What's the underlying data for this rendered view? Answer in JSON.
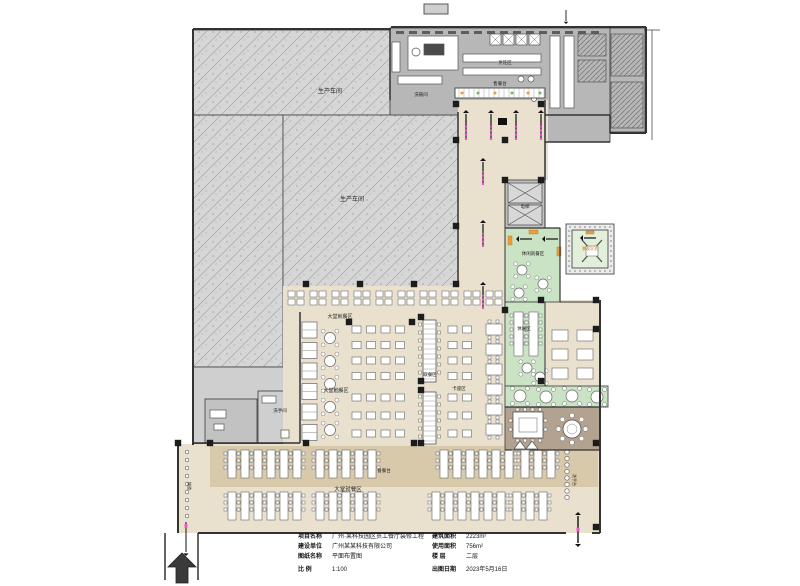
{
  "document": {
    "type": "architectural-floor-plan",
    "sheet_name": "平面布置图"
  },
  "colors": {
    "beige": "#e9e0cd",
    "tan": "#d8c9ab",
    "hatch_gray": "#d6d6d6",
    "room_gray": "#cfcfcf",
    "gray2": "#c2c2c2",
    "kitchen_gray": "#b7b7b7",
    "wall": "#333333",
    "green": "#c9e3c4",
    "pale_green": "#e2efdb",
    "stone": "#ededed",
    "taupe": "#b3a290",
    "magenta": "#ee55d2",
    "orange": "#eb9c3f",
    "white": "#ffffff",
    "ink": "#222222"
  },
  "titleblock": {
    "left": [
      {
        "label": "项目名称",
        "value": "广州·某科技园区员工餐厅装修工程"
      },
      {
        "label": "建设单位",
        "value": "广州某某科技有限公司"
      },
      {
        "label": "图纸名称",
        "value": "平面布置图"
      },
      {
        "label": "比    例",
        "value": "1:100"
      }
    ],
    "right": [
      {
        "label": "建筑面积",
        "value": "2223m²"
      },
      {
        "label": "使用面积",
        "value": "756m²"
      },
      {
        "label": "楼    层",
        "value": "二层"
      },
      {
        "label": "出图日期",
        "value": "2023年5月16日"
      }
    ]
  },
  "plan": {
    "regions": [
      {
        "name": "workshop-top",
        "x": 193,
        "y": 30,
        "w": 197,
        "h": 85,
        "f": "hatch"
      },
      {
        "name": "workshop-left",
        "x": 193,
        "y": 115,
        "w": 90,
        "h": 252,
        "f": "hatch"
      },
      {
        "name": "workshop-mid",
        "x": 283,
        "y": 115,
        "w": 175,
        "h": 173,
        "f": "hatch"
      },
      {
        "name": "utility-block",
        "x": 193,
        "y": 367,
        "w": 107,
        "h": 77,
        "f": "lightgray"
      },
      {
        "name": "utility-room-1",
        "x": 205,
        "y": 399,
        "w": 52,
        "h": 44,
        "f": "gray2"
      },
      {
        "name": "utility-room-2",
        "x": 258,
        "y": 391,
        "w": 42,
        "h": 52,
        "f": "lightgray"
      },
      {
        "name": "kitchen-main",
        "x": 390,
        "y": 28,
        "w": 220,
        "h": 87,
        "f": "gray"
      },
      {
        "name": "kitchen-store",
        "x": 545,
        "y": 115,
        "w": 65,
        "h": 27,
        "f": "gray"
      },
      {
        "name": "kitchen-east-rooms",
        "x": 610,
        "y": 28,
        "w": 35,
        "h": 104,
        "f": "gray"
      },
      {
        "name": "hall-serving-front",
        "x": 458,
        "y": 100,
        "w": 90,
        "h": 80,
        "f": "beige"
      },
      {
        "name": "hall-corridor",
        "x": 458,
        "y": 180,
        "w": 47,
        "h": 132,
        "f": "beige"
      },
      {
        "name": "hall-mid-dining",
        "x": 283,
        "y": 286,
        "w": 225,
        "h": 161,
        "f": "beige"
      },
      {
        "name": "hall-east-dining",
        "x": 545,
        "y": 300,
        "w": 55,
        "h": 86,
        "f": "beige"
      },
      {
        "name": "hall-south-dining",
        "x": 178,
        "y": 444,
        "w": 422,
        "h": 89,
        "f": "beige"
      },
      {
        "name": "south-tan-band",
        "x": 210,
        "y": 446,
        "w": 388,
        "h": 41,
        "f": "tan"
      },
      {
        "name": "lift-block",
        "x": 505,
        "y": 180,
        "w": 40,
        "h": 48,
        "f": "gray2"
      },
      {
        "name": "leisure-green-1",
        "x": 505,
        "y": 228,
        "w": 55,
        "h": 74,
        "f": "green"
      },
      {
        "name": "leisure-green-2",
        "x": 505,
        "y": 302,
        "w": 40,
        "h": 84,
        "f": "green"
      },
      {
        "name": "leisure-green-3",
        "x": 505,
        "y": 386,
        "w": 103,
        "h": 21,
        "f": "green"
      },
      {
        "name": "courtyard-border",
        "x": 566,
        "y": 224,
        "w": 48,
        "h": 50,
        "f": "stone"
      },
      {
        "name": "courtyard-garden",
        "x": 572,
        "y": 230,
        "w": 36,
        "h": 38,
        "f": "palegreen"
      },
      {
        "name": "vip-room",
        "x": 505,
        "y": 407,
        "w": 95,
        "h": 43,
        "f": "taupe"
      },
      {
        "name": "roof-vent",
        "x": 424,
        "y": 4,
        "w": 24,
        "h": 10,
        "f": "lightgray"
      }
    ],
    "walls": [
      [
        193,
        29,
        391,
        29,
        2
      ],
      [
        391,
        27,
        646,
        27,
        2
      ],
      [
        646,
        27,
        646,
        133,
        2
      ],
      [
        610,
        133,
        646,
        133,
        2
      ],
      [
        610,
        115,
        610,
        133,
        1.5
      ],
      [
        193,
        29,
        193,
        445,
        2
      ],
      [
        193,
        443,
        300,
        443,
        1.5
      ],
      [
        300,
        312,
        300,
        443,
        1.5
      ],
      [
        390,
        28,
        390,
        100,
        1.5
      ],
      [
        458,
        112,
        458,
        286,
        1.5
      ],
      [
        545,
        100,
        545,
        180,
        1.5
      ],
      [
        545,
        115,
        610,
        115,
        1.5
      ],
      [
        545,
        142,
        610,
        142,
        1.5
      ],
      [
        505,
        180,
        505,
        312,
        1
      ],
      [
        545,
        180,
        545,
        228,
        1
      ],
      [
        560,
        228,
        560,
        302,
        1.2
      ],
      [
        505,
        228,
        560,
        228,
        1.2
      ],
      [
        545,
        302,
        545,
        386,
        1
      ],
      [
        560,
        302,
        600,
        302,
        1
      ],
      [
        600,
        300,
        600,
        533,
        2
      ],
      [
        505,
        407,
        600,
        407,
        1.2
      ],
      [
        505,
        450,
        512,
        450,
        1.2
      ],
      [
        530,
        450,
        600,
        450,
        1.2
      ],
      [
        178,
        443,
        178,
        533,
        2
      ],
      [
        198,
        533,
        566,
        533,
        2
      ],
      [
        592,
        533,
        600,
        533,
        2
      ],
      [
        165,
        533,
        165,
        580,
        1.5
      ],
      [
        198,
        533,
        198,
        580,
        1.5
      ],
      [
        652,
        30,
        652,
        140,
        0.7
      ],
      [
        644,
        30,
        660,
        30,
        0.7
      ]
    ],
    "columns": [
      [
        306,
        284
      ],
      [
        360,
        284
      ],
      [
        414,
        284
      ],
      [
        306,
        443
      ],
      [
        414,
        443
      ],
      [
        456,
        140
      ],
      [
        505,
        140
      ],
      [
        456,
        226
      ],
      [
        456,
        284
      ],
      [
        505,
        310
      ],
      [
        421,
        317
      ],
      [
        421,
        381
      ],
      [
        421,
        390
      ],
      [
        421,
        443
      ],
      [
        349,
        322
      ],
      [
        412,
        322
      ],
      [
        541,
        300
      ],
      [
        596,
        300
      ],
      [
        541,
        381
      ],
      [
        596,
        329
      ],
      [
        210,
        443
      ],
      [
        596,
        443
      ],
      [
        596,
        527
      ],
      [
        456,
        104
      ],
      [
        541,
        104
      ],
      [
        505,
        180
      ],
      [
        541,
        180
      ],
      [
        178,
        443
      ]
    ],
    "labels": [
      {
        "t": "生产车间",
        "x": 330,
        "y": 93,
        "s": 6
      },
      {
        "t": "生产车间",
        "x": 352,
        "y": 201,
        "s": 6
      },
      {
        "t": "洗碗间",
        "x": 421,
        "y": 96,
        "s": 4.5
      },
      {
        "t": "烹饪区",
        "x": 505,
        "y": 64,
        "s": 4.5
      },
      {
        "t": "售餐台",
        "x": 500,
        "y": 85,
        "s": 4.5
      },
      {
        "t": "大堂就餐区",
        "x": 340,
        "y": 318,
        "s": 5
      },
      {
        "t": "大堂就餐区",
        "x": 336,
        "y": 392,
        "s": 5
      },
      {
        "t": "取餐区",
        "x": 430,
        "y": 376,
        "s": 4.5
      },
      {
        "t": "卡座区",
        "x": 459,
        "y": 390,
        "s": 4.5
      },
      {
        "t": "休闲就餐区",
        "x": 533,
        "y": 255,
        "s": 4.5
      },
      {
        "t": "景观水池",
        "x": 590,
        "y": 250,
        "s": 4,
        "c": "#d07818"
      },
      {
        "t": "休闲区",
        "x": 524,
        "y": 330,
        "s": 4.5
      },
      {
        "t": "大堂就餐区",
        "x": 348,
        "y": 491,
        "s": 5.5
      },
      {
        "t": "备餐台",
        "x": 384,
        "y": 472,
        "s": 4.5
      },
      {
        "t": "洗手间",
        "x": 280,
        "y": 412,
        "s": 4.5
      },
      {
        "t": "电梯",
        "x": 525,
        "y": 208,
        "s": 4.5
      },
      {
        "t": "坡道",
        "x": 188,
        "y": 486,
        "s": 4,
        "v": 1
      },
      {
        "t": "洗手台",
        "x": 573,
        "y": 480,
        "s": 4,
        "v": 1
      }
    ],
    "furniture": [
      {
        "type": "clusterRow",
        "x": 288,
        "y": 291,
        "count": 10,
        "step": 22
      },
      {
        "type": "booths",
        "x": 302,
        "y": 322,
        "count": 6,
        "step": 20.5
      },
      {
        "type": "roundTables",
        "r": 5.5,
        "pts": [
          [
            330,
            338
          ],
          [
            330,
            361
          ],
          [
            330,
            384
          ],
          [
            330,
            407
          ],
          [
            330,
            430
          ]
        ]
      },
      {
        "type": "grid",
        "x": 352,
        "y": 326,
        "cols": 4,
        "rows": 4,
        "cw": 9,
        "ch": 7,
        "gx": 5.5,
        "gy": 8.5
      },
      {
        "type": "grid",
        "x": 352,
        "y": 394,
        "cols": 4,
        "rows": 3,
        "cw": 9,
        "ch": 7,
        "gx": 5.5,
        "gy": 11
      },
      {
        "type": "counter",
        "x": 423,
        "y": 320,
        "w": 13,
        "h": 62
      },
      {
        "type": "counter",
        "x": 423,
        "y": 392,
        "w": 13,
        "h": 52
      },
      {
        "type": "grid",
        "x": 448,
        "y": 326,
        "cols": 2,
        "rows": 4,
        "cw": 9,
        "ch": 7,
        "gx": 5.5,
        "gy": 8.5
      },
      {
        "type": "grid",
        "x": 448,
        "y": 394,
        "cols": 2,
        "rows": 3,
        "cw": 9,
        "ch": 7,
        "gx": 5.5,
        "gy": 11
      },
      {
        "type": "seatTables",
        "x": 486,
        "y": 324,
        "count": 6,
        "step": 20
      },
      {
        "type": "longTables",
        "x": 514,
        "y": 312,
        "count": 2,
        "step": 15,
        "tw": 9,
        "th": 44
      },
      {
        "type": "grid",
        "x": 552,
        "y": 330,
        "cols": 2,
        "rows": 3,
        "cw": 16,
        "ch": 11,
        "gx": 9,
        "gy": 8
      },
      {
        "type": "roundTables",
        "r": 5,
        "pts": [
          [
            522,
            270
          ],
          [
            543,
            284
          ],
          [
            519,
            293
          ],
          [
            527,
            368
          ],
          [
            540,
            377
          ]
        ]
      },
      {
        "type": "roundTables",
        "r": 6,
        "pts": [
          [
            520,
            396
          ],
          [
            546,
            397
          ],
          [
            572,
            396
          ],
          [
            597,
            397
          ]
        ]
      },
      {
        "type": "benches",
        "rects": [
          [
            508,
            236,
            4,
            9
          ],
          [
            557,
            247,
            4,
            9
          ],
          [
            529,
            230,
            9,
            4
          ],
          [
            586,
            231,
            8,
            3
          ]
        ]
      },
      {
        "type": "longTables",
        "x": 228,
        "y": 450,
        "count": 6,
        "step": 13,
        "tw": 8,
        "th": 28
      },
      {
        "type": "longTables",
        "x": 316,
        "y": 450,
        "count": 5,
        "step": 13,
        "tw": 8,
        "th": 28
      },
      {
        "type": "longTables",
        "x": 440,
        "y": 450,
        "count": 6,
        "step": 13,
        "tw": 8,
        "th": 28
      },
      {
        "type": "longTables",
        "x": 521,
        "y": 450,
        "count": 3,
        "step": 13,
        "tw": 8,
        "th": 28
      },
      {
        "type": "longTables",
        "x": 228,
        "y": 492,
        "count": 6,
        "step": 13,
        "tw": 8,
        "th": 28
      },
      {
        "type": "longTables",
        "x": 316,
        "y": 492,
        "count": 5,
        "step": 13,
        "tw": 8,
        "th": 28
      },
      {
        "type": "longTables",
        "x": 432,
        "y": 492,
        "count": 6,
        "step": 13,
        "tw": 8,
        "th": 28
      },
      {
        "type": "longTables",
        "x": 513,
        "y": 492,
        "count": 3,
        "step": 13,
        "tw": 8,
        "th": 28
      },
      {
        "type": "stools",
        "x": 567,
        "y": 452,
        "count": 8,
        "step": 6.5,
        "r": 2.2
      },
      {
        "type": "stools",
        "x": 187,
        "y": 452,
        "count": 9,
        "step": 8,
        "r": 1.8
      },
      {
        "type": "sqTableRing",
        "x": 513,
        "y": 412
      },
      {
        "type": "roundBig",
        "cx": 572,
        "cy": 429,
        "r": 9
      }
    ],
    "kitchen": {
      "hood": {
        "y": 31,
        "x0": 396,
        "x1": 600,
        "step": 13
      },
      "rects": [
        [
          408,
          36,
          50,
          34,
          "w"
        ],
        [
          424,
          44,
          20,
          11,
          "d"
        ],
        [
          463,
          54,
          78,
          8,
          "w"
        ],
        [
          463,
          68,
          78,
          7,
          "w"
        ],
        [
          398,
          76,
          44,
          8,
          "w"
        ],
        [
          392,
          42,
          8,
          30,
          "w"
        ],
        [
          550,
          36,
          10,
          72,
          "w"
        ],
        [
          564,
          36,
          10,
          72,
          "w"
        ],
        [
          578,
          34,
          28,
          22,
          "h"
        ],
        [
          578,
          60,
          28,
          22,
          "h"
        ],
        [
          611,
          34,
          32,
          42,
          "h"
        ],
        [
          611,
          82,
          32,
          46,
          "h"
        ]
      ],
      "serving": {
        "x": 455,
        "y": 88,
        "w": 90,
        "h": 10
      },
      "servingDots": [
        [
          462,
          93
        ],
        [
          478,
          93
        ],
        [
          495,
          93
        ],
        [
          512,
          93
        ],
        [
          528,
          93
        ],
        [
          540,
          93
        ]
      ],
      "circles": [
        [
          416,
          52,
          4
        ],
        [
          521,
          79,
          3
        ],
        [
          531,
          79,
          3
        ],
        [
          525,
          95,
          2.5
        ],
        [
          534,
          99,
          2.5
        ],
        [
          541,
          93,
          2.5
        ]
      ],
      "woks": [
        [
          490,
          34,
          11
        ],
        [
          503,
          34,
          11
        ],
        [
          516,
          34,
          11
        ],
        [
          529,
          34,
          11
        ]
      ],
      "ufix": [
        [
          210,
          410,
          16,
          8
        ],
        [
          214,
          424,
          10,
          6
        ],
        [
          262,
          396,
          14,
          7
        ],
        [
          281,
          430,
          8,
          8
        ]
      ]
    },
    "arrows": {
      "flowUp": [
        {
          "x": 466,
          "head": 110,
          "tail": 140
        },
        {
          "x": 491,
          "head": 110,
          "tail": 140
        },
        {
          "x": 516,
          "head": 110,
          "tail": 140
        },
        {
          "x": 541,
          "head": 110,
          "tail": 140
        },
        {
          "x": 483,
          "head": 158,
          "tail": 185
        },
        {
          "x": 483,
          "head": 220,
          "tail": 247
        },
        {
          "x": 483,
          "head": 282,
          "tail": 309
        }
      ],
      "flowLeft": [
        {
          "x1": 532,
          "x2": 516,
          "y": 239
        },
        {
          "x1": 558,
          "x2": 542,
          "y": 239
        },
        {
          "x1": 596,
          "x2": 580,
          "y": 238
        }
      ],
      "blackRect": [
        498,
        118,
        9,
        7
      ],
      "dblArrow": {
        "x": 578,
        "y1": 512,
        "y2": 547
      },
      "thinDown": {
        "x": 186,
        "y1": 522,
        "y2": 556
      },
      "topDown": {
        "x": 566,
        "y1": 10,
        "y2": 24
      },
      "bigArrow": {
        "cx": 182,
        "tipY": 553,
        "baseY": 583,
        "w": 28,
        "shaft": 12
      }
    }
  }
}
